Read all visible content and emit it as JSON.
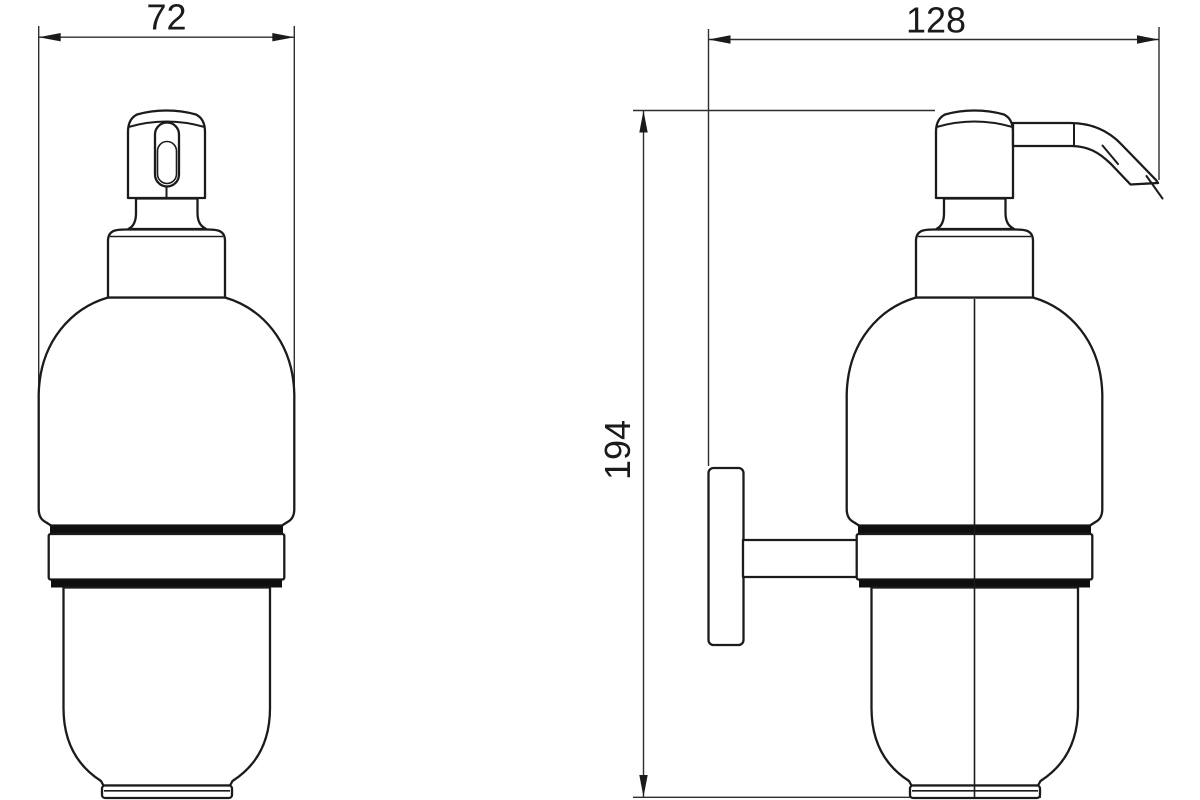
{
  "drawing": {
    "background_color": "#ffffff",
    "line_color": "#1b1b1b",
    "views": {
      "front": {
        "width_dimension": "72"
      },
      "side": {
        "width_dimension": "128",
        "height_dimension": "194"
      }
    }
  }
}
